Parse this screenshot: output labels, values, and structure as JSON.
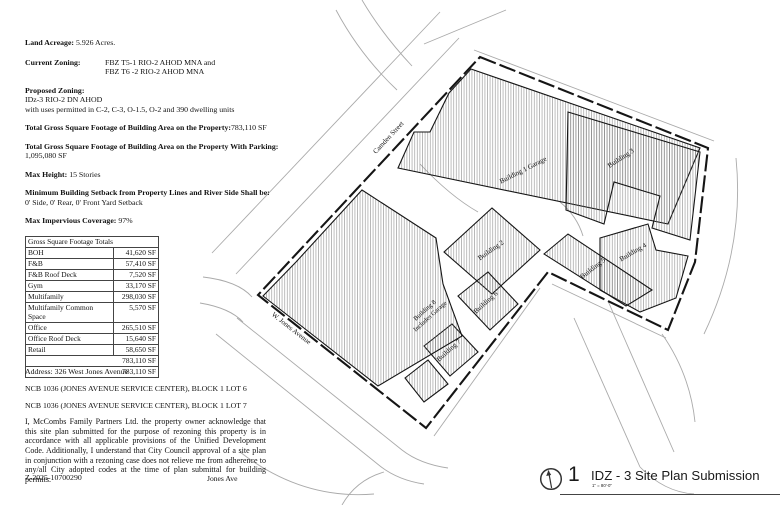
{
  "left_panel": {
    "land_acreage_label": "Land Acreage:",
    "land_acreage_value": "5.926 Acres.",
    "current_zoning_label": "Current Zoning:",
    "current_zoning_line1": "FBZ T5-1  RIO-2 AHOD MNA  and",
    "current_zoning_line2": "FBZ T6 -2 RIO-2 AHOD MNA",
    "proposed_zoning_label": "Proposed Zoning:",
    "proposed_zoning_line1": "IDz-3 RIO-2 DN AHOD",
    "proposed_zoning_line2": "with uses permitted in C-2, C-3, O-1.5, O-2 and 390 dwelling units",
    "total_gsf_label": "Total Gross Square Footage of Building Area on the Property:",
    "total_gsf_value": "783,110 SF",
    "total_gsf_parking_label": "Total Gross Square Footage of Building Area on the Property With Parking:",
    "total_gsf_parking_value": "1,095,080 SF",
    "max_height_label": "Max Height:",
    "max_height_value": "15 Stories",
    "setback_label": "Minimum Building Setback from Property Lines and River Side Shall be:",
    "setback_value": "0' Side, 0' Rear, 0' Front Yard Setback",
    "impervious_label": "Max Impervious Coverage:",
    "impervious_value": "97%"
  },
  "gsf_table": {
    "title": "Gross Square Footage Totals",
    "rows": [
      {
        "use": "BOH",
        "sf": "41,620 SF"
      },
      {
        "use": "F&B",
        "sf": "57,410 SF"
      },
      {
        "use": "F&B Roof Deck",
        "sf": "7,520 SF"
      },
      {
        "use": "Gym",
        "sf": "33,170 SF"
      },
      {
        "use": "Multifamily",
        "sf": "298,030 SF"
      },
      {
        "use": "Multifamily Common Space",
        "sf": "5,570 SF"
      },
      {
        "use": "Office",
        "sf": "265,510 SF"
      },
      {
        "use": "Office Roof Deck",
        "sf": "15,640 SF"
      },
      {
        "use": "Retail",
        "sf": "58,650 SF"
      }
    ],
    "total_row1": "783,110 SF",
    "total_row2": "783,110 SF"
  },
  "address_block": {
    "address": "Address: 326 West Jones Avenue",
    "ncb_lot6": "NCB 1036 (JONES AVENUE SERVICE CENTER), BLOCK 1 LOT 6",
    "ncb_lot7": "NCB 1036 (JONES AVENUE SERVICE CENTER), BLOCK 1 LOT 7",
    "acknowledgment": "I, McCombs Family Partners Ltd. the property owner acknowledge that this site plan submitted for the purpose of rezoning this property is in accordance with all applicable provisions of the Unified Development Code. Additionally, I understand that City Council approval of a site plan in conjunction with a rezoning case does not relieve me from adherence to any/all City adopted codes at the time of plan submittal for building permits."
  },
  "footer": {
    "case_number": "Z-2025-10700290",
    "street_note": "Jones Ave"
  },
  "site_plan": {
    "streets": {
      "camden": "Camden Street",
      "w_jones": "W. Jones Avenue"
    },
    "buildings": {
      "b1": "Building 1 Garage",
      "b2": "Building 2",
      "b3": "Building 3",
      "b4": "Building 4",
      "b5": "Building 5",
      "b6": "Building 6",
      "b7": "Building 7",
      "b8_line1": "Building 8",
      "b8_line2": "Includes Garage"
    }
  },
  "title_block": {
    "sheet_number": "1",
    "title": "IDZ - 3 Site Plan Submission",
    "scale": "1\" = 80'-0\""
  }
}
